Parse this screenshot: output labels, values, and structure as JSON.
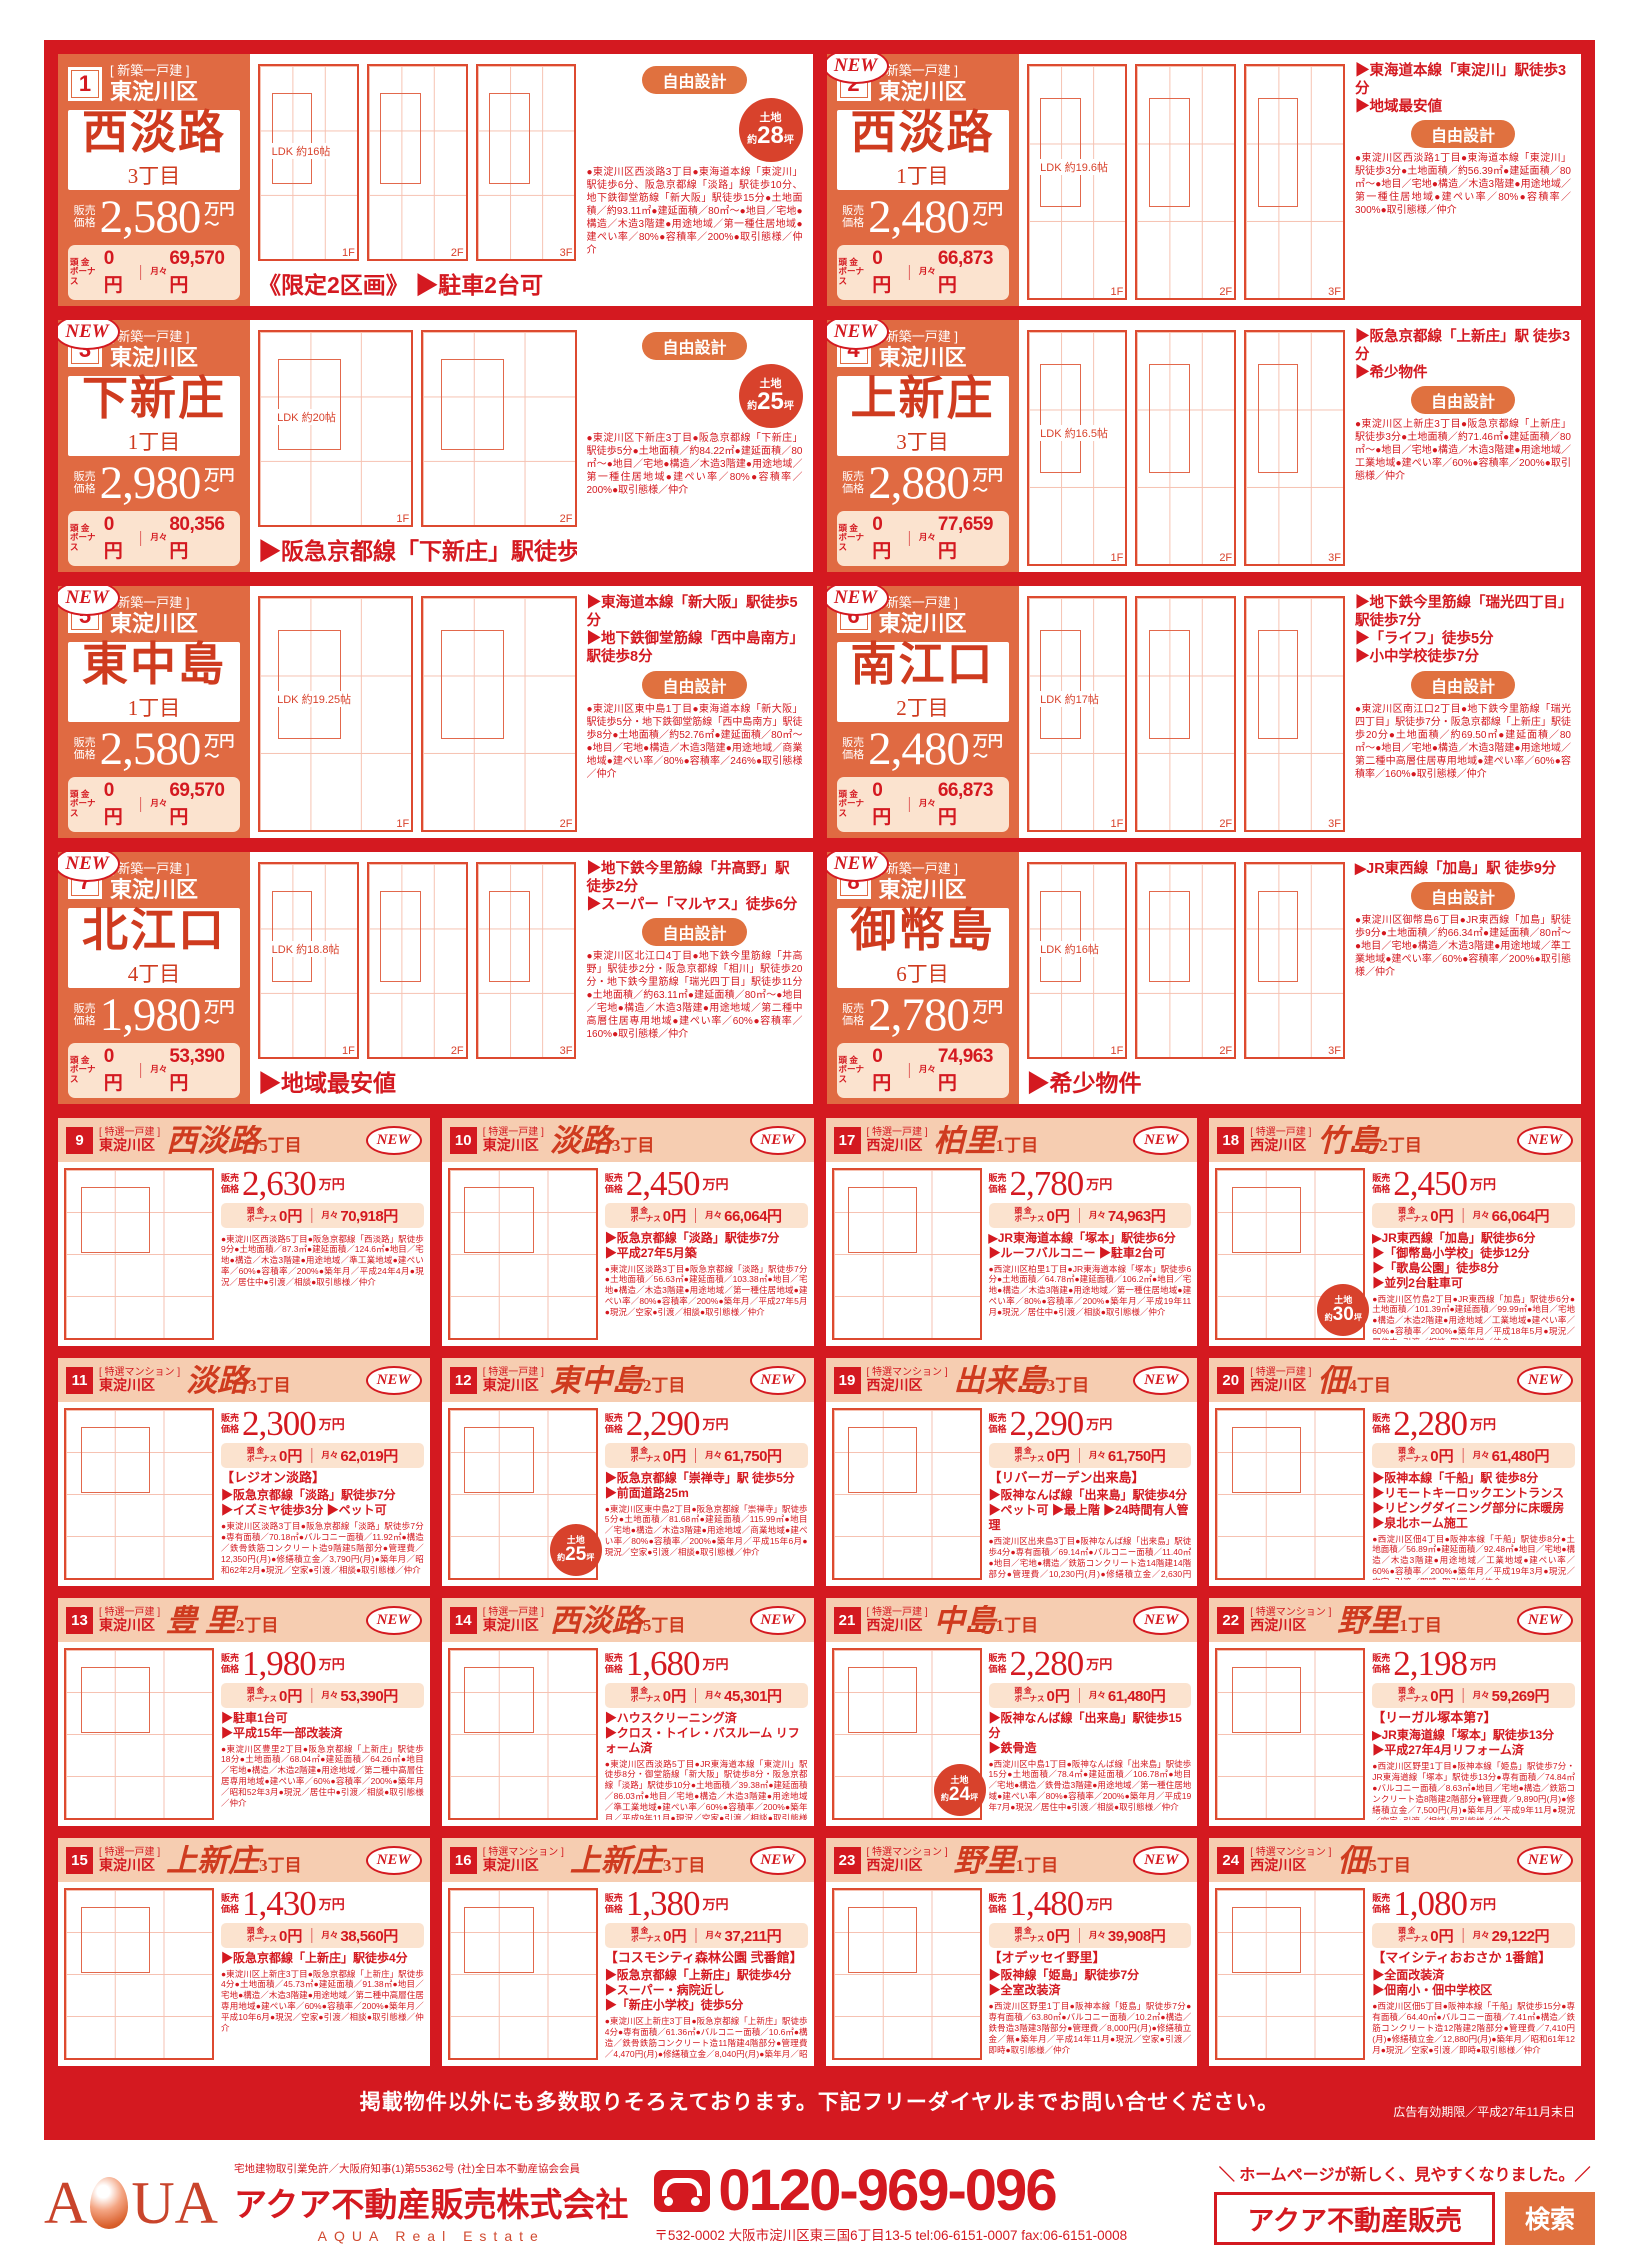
{
  "shared": {
    "new_label": "NEW",
    "price_label": [
      "販売",
      "価格"
    ],
    "unit": "万円",
    "tilde": "〜",
    "down1": "頭 金",
    "down2": "ボーナス",
    "zero": "0円",
    "sep": "｜",
    "monthly_label": "月々",
    "yen": "円",
    "land_label": "土地",
    "land_pre": "約",
    "land_suf": "坪"
  },
  "big_listings": [
    {
      "num": "1",
      "new": false,
      "type": "[ 新築一戸建 ]",
      "ward": "東淀川区",
      "name": "西淡路",
      "chome": "3丁目",
      "price": "2,580",
      "monthly": "69,570",
      "headline": "《限定2区画》 ▶駐車2台可",
      "bullets": [],
      "pill": "自由設計",
      "land": "28",
      "plan_label": "LDK 約16帖",
      "floors": [
        "1F",
        "2F",
        "3F"
      ],
      "desc": "●東淀川区西淡路3丁目●東海道本線「東淀川」駅徒歩6分、阪急京都線「淡路」駅徒歩10分、地下鉄御堂筋線「新大阪」駅徒歩15分●土地面積／約93.11㎡●建延面積／80㎡〜●地目／宅地●構造／木造3階建●用途地域／第一種住居地域●建ぺい率／80%●容積率／200%●取引態様／仲介"
    },
    {
      "num": "2",
      "new": true,
      "type": "[ 新築一戸建 ]",
      "ward": "東淀川区",
      "name": "西淡路",
      "chome": "1丁目",
      "price": "2,480",
      "monthly": "66,873",
      "headline": "",
      "bullets": [
        "▶東海道本線「東淀川」駅徒歩3分",
        "▶地域最安値"
      ],
      "pill": "自由設計",
      "land": "",
      "plan_label": "LDK 約19.6帖",
      "floors": [
        "1F",
        "2F",
        "3F"
      ],
      "desc": "●東淀川区西淡路1丁目●東海道本線「東淀川」駅徒歩3分●土地面積／約56.39㎡●建延面積／80㎡〜●地目／宅地●構造／木造3階建●用途地域／第一種住居地域●建ぺい率／80%●容積率／300%●取引態様／仲介"
    },
    {
      "num": "3",
      "new": true,
      "type": "[ 新築一戸建 ]",
      "ward": "東淀川区",
      "name": "下新庄",
      "chome": "1丁目",
      "price": "2,980",
      "monthly": "80,356",
      "headline": "▶阪急京都線「下新庄」駅徒歩5分",
      "bullets": [],
      "pill": "自由設計",
      "land": "25",
      "plan_label": "LDK 約20帖",
      "floors": [
        "1F",
        "2F"
      ],
      "desc": "●東淀川区下新庄3丁目●阪急京都線「下新庄」駅徒歩5分●土地面積／約84.22㎡●建延面積／80㎡〜●地目／宅地●構造／木造3階建●用途地域／第一種住居地域●建ぺい率／80%●容積率／200%●取引態様／仲介"
    },
    {
      "num": "4",
      "new": true,
      "type": "[ 新築一戸建 ]",
      "ward": "東淀川区",
      "name": "上新庄",
      "chome": "3丁目",
      "price": "2,880",
      "monthly": "77,659",
      "headline": "",
      "bullets": [
        "▶阪急京都線「上新庄」駅 徒歩3分",
        "▶希少物件"
      ],
      "pill": "自由設計",
      "land": "",
      "plan_label": "LDK 約16.5帖",
      "floors": [
        "1F",
        "2F",
        "3F"
      ],
      "desc": "●東淀川区上新庄3丁目●阪急京都線「上新庄」駅徒歩3分●土地面積／約71.46㎡●建延面積／80㎡〜●地目／宅地●構造／木造3階建●用途地域／工業地域●建ぺい率／60%●容積率／200%●取引態様／仲介"
    },
    {
      "num": "5",
      "new": true,
      "type": "[ 新築一戸建 ]",
      "ward": "東淀川区",
      "name": "東中島",
      "chome": "1丁目",
      "price": "2,580",
      "monthly": "69,570",
      "headline": "",
      "bullets": [
        "▶東海道本線「新大阪」駅徒歩5分",
        "▶地下鉄御堂筋線「西中島南方」駅徒歩8分"
      ],
      "pill": "自由設計",
      "land": "",
      "plan_label": "LDK 約19.25帖",
      "floors": [
        "1F",
        "2F"
      ],
      "desc": "●東淀川区東中島1丁目●東海道本線「新大阪」駅徒歩5分・地下鉄御堂筋線「西中島南方」駅徒歩8分●土地面積／約52.76㎡●建延面積／80㎡〜●地目／宅地●構造／木造3階建●用途地域／商業地域●建ぺい率／80%●容積率／246%●取引態様／仲介"
    },
    {
      "num": "6",
      "new": true,
      "type": "[ 新築一戸建 ]",
      "ward": "東淀川区",
      "name": "南江口",
      "chome": "2丁目",
      "price": "2,480",
      "monthly": "66,873",
      "headline": "",
      "bullets": [
        "▶地下鉄今里筋線「瑞光四丁目」駅徒歩7分",
        "▶「ライフ」徒歩5分",
        "▶小中学校徒歩7分"
      ],
      "pill": "自由設計",
      "land": "",
      "plan_label": "LDK 約17帖",
      "floors": [
        "1F",
        "2F",
        "3F"
      ],
      "desc": "●東淀川区南江口2丁目●地下鉄今里筋線「瑞光四丁目」駅徒歩7分・阪急京都線「上新庄」駅徒歩20分●土地面積／約69.50㎡●建延面積／80㎡〜●地目／宅地●構造／木造3階建●用途地域／第二種中高層住居専用地域●建ぺい率／60%●容積率／160%●取引態様／仲介"
    },
    {
      "num": "7",
      "new": true,
      "type": "[ 新築一戸建 ]",
      "ward": "東淀川区",
      "name": "北江口",
      "chome": "4丁目",
      "price": "1,980",
      "monthly": "53,390",
      "headline": "▶地域最安値",
      "bullets": [
        "▶地下鉄今里筋線「井高野」駅徒歩2分",
        "▶スーパー「マルヤス」徒歩6分"
      ],
      "pill": "自由設計",
      "land": "",
      "plan_label": "LDK 約18.8帖",
      "floors": [
        "1F",
        "2F",
        "3F"
      ],
      "desc": "●東淀川区北江口4丁目●地下鉄今里筋線「井高野」駅徒歩2分・阪急京都線「相川」駅徒歩20分・地下鉄今里筋線「瑞光四丁目」駅徒歩11分●土地面積／約63.11㎡●建延面積／80㎡〜●地目／宅地●構造／木造3階建●用途地域／第二種中高層住居専用地域●建ぺい率／60%●容積率／160%●取引態様／仲介"
    },
    {
      "num": "8",
      "new": true,
      "type": "[ 新築一戸建 ]",
      "ward": "東淀川区",
      "name": "御幣島",
      "chome": "6丁目",
      "price": "2,780",
      "monthly": "74,963",
      "headline": "▶希少物件",
      "bullets": [
        "▶JR東西線「加島」駅 徒歩9分"
      ],
      "pill": "自由設計",
      "land": "",
      "plan_label": "LDK 約16帖",
      "floors": [
        "1F",
        "2F",
        "3F"
      ],
      "desc": "●東淀川区御幣島6丁目●JR東西線「加島」駅徒歩9分●土地面積／約66.34㎡●建延面積／80㎡〜●地目／宅地●構造／木造3階建●用途地域／準工業地域●建ぺい率／60%●容積率／200%●取引態様／仲介"
    }
  ],
  "small_listings": [
    {
      "num": "9",
      "new": true,
      "type": "[ 特選一戸建 ]",
      "ward": "東淀川区",
      "name": "西淡路",
      "chome": "5丁目",
      "price": "2,630",
      "monthly": "70,918",
      "bldg": "",
      "bullets": [],
      "land": "",
      "desc": "●東淀川区西淡路5丁目●阪急京都線「西淡路」駅徒歩9分●土地面積／87.3㎡●建延面積／124.6㎡●地目／宅地●構造／木造3階建●用途地域／準工業地域●建ぺい率／60%●容積率／200%●築年月／平成24年4月●現況／居住中●引渡／相談●取引態様／仲介"
    },
    {
      "num": "10",
      "new": true,
      "type": "[ 特選一戸建 ]",
      "ward": "東淀川区",
      "name": "淡路",
      "chome": "3丁目",
      "price": "2,450",
      "monthly": "66,064",
      "bldg": "",
      "bullets": [
        "▶阪急京都線「淡路」駅徒歩7分",
        "▶平成27年5月築"
      ],
      "land": "",
      "desc": "●東淀川区淡路3丁目●阪急京都線「淡路」駅徒歩7分●土地面積／56.63㎡●建延面積／103.38㎡●地目／宅地●構造／木造3階建●用途地域／第一種住居地域●建ぺい率／80%●容積率／200%●築年月／平成27年5月●現況／空家●引渡／相談●取引態様／仲介"
    },
    {
      "num": "17",
      "new": true,
      "type": "[ 特選一戸建 ]",
      "ward": "西淀川区",
      "name": "柏里",
      "chome": "1丁目",
      "price": "2,780",
      "monthly": "74,963",
      "bldg": "",
      "bullets": [
        "▶JR東海道本線「塚本」駅徒歩6分",
        "▶ルーフバルコニー ▶駐車2台可"
      ],
      "land": "",
      "desc": "●西淀川区柏里1丁目●JR東海道本線「塚本」駅徒歩6分●土地面積／64.78㎡●建延面積／106.2㎡●地目／宅地●構造／木造3階建●用途地域／第一種住居地域●建ぺい率／80%●容積率／200%●築年月／平成19年11月●現況／居住中●引渡／相談●取引態様／仲介"
    },
    {
      "num": "18",
      "new": true,
      "type": "[ 特選一戸建 ]",
      "ward": "西淀川区",
      "name": "竹島",
      "chome": "2丁目",
      "price": "2,450",
      "monthly": "66,064",
      "bldg": "",
      "bullets": [
        "▶JR東西線「加島」駅徒歩6分",
        "▶「御幣島小学校」徒歩12分",
        "▶「歌島公園」徒歩8分",
        "▶並列2台駐車可"
      ],
      "land": "30",
      "desc": "●西淀川区竹島2丁目●JR東西線「加島」駅徒歩6分●土地面積／101.39㎡●建延面積／99.99㎡●地目／宅地●構造／木造2階建●用途地域／工業地域●建ぺい率／60%●容積率／200%●築年月／平成18年5月●現況／居住中●引渡／相談●取引態様／仲介"
    },
    {
      "num": "11",
      "new": true,
      "type": "[ 特選マンション ]",
      "ward": "東淀川区",
      "name": "淡路",
      "chome": "3丁目",
      "price": "2,300",
      "monthly": "62,019",
      "bldg": "【レジオン淡路】",
      "bullets": [
        "▶阪急京都線「淡路」駅徒歩7分",
        "▶イズミヤ徒歩3分 ▶ペット可"
      ],
      "land": "",
      "desc": "●東淀川区淡路3丁目●阪急京都線「淡路」駅徒歩7分●専有面積／70.18㎡●バルコニー面積／11.92㎡●構造／鉄骨鉄筋コンクリート造9階建5階部分●管理費／12,350円(月)●修繕積立金／3,790円(月)●築年月／昭和62年2月●現況／空家●引渡／相談●取引態様／仲介"
    },
    {
      "num": "12",
      "new": true,
      "type": "[ 特選一戸建 ]",
      "ward": "東淀川区",
      "name": "東中島",
      "chome": "2丁目",
      "price": "2,290",
      "monthly": "61,750",
      "bldg": "",
      "bullets": [
        "▶阪急京都線「崇禅寺」駅 徒歩5分",
        "▶前面道路25m"
      ],
      "land": "25",
      "desc": "●東淀川区東中島2丁目●阪急京都線「崇禅寺」駅徒歩5分●土地面積／81.68㎡●建延面積／115.99㎡●地目／宅地●構造／木造3階建●用途地域／商業地域●建ぺい率／80%●容積率／200%●築年月／平成15年6月●現況／空家●引渡／相談●取引態様／仲介"
    },
    {
      "num": "19",
      "new": true,
      "type": "[ 特選マンション ]",
      "ward": "西淀川区",
      "name": "出来島",
      "chome": "3丁目",
      "price": "2,290",
      "monthly": "61,750",
      "bldg": "【リバーガーデン出来島】",
      "bullets": [
        "▶阪神なんば線「出来島」駅徒歩4分",
        "▶ペット可 ▶最上階 ▶24時間有人管理"
      ],
      "land": "",
      "desc": "●西淀川区出来島3丁目●阪神なんば線「出来島」駅徒歩4分●専有面積／69.14㎡●バルコニー面積／11.40㎡●地目／宅地●構造／鉄筋コンクリート造14階建14階部分●管理費／10,230円(月)●修繕積立金／2,630円(月)●築年月／平成18年7月●現況／空家●引渡／即時●取引態様／仲介"
    },
    {
      "num": "20",
      "new": true,
      "type": "[ 特選一戸建 ]",
      "ward": "西淀川区",
      "name": "佃",
      "chome": "4丁目",
      "price": "2,280",
      "monthly": "61,480",
      "bldg": "",
      "bullets": [
        "▶阪神本線「千船」駅 徒歩8分",
        "▶リモートキーロックエントランス",
        "▶リビングダイニング部分に床暖房",
        "▶泉北ホーム施工"
      ],
      "land": "",
      "desc": "●西淀川区佃4丁目●阪神本線「千船」駅徒歩8分●土地面積／56.89㎡●建延面積／92.48㎡●地目／宅地●構造／木造3階建●用途地域／工業地域●建ぺい率／60%●容積率／200%●築年月／平成19年3月●現況／空家●引渡／即時●取引態様／仲介"
    },
    {
      "num": "13",
      "new": true,
      "type": "[ 特選一戸建 ]",
      "ward": "東淀川区",
      "name": "豊 里",
      "chome": "2丁目",
      "price": "1,980",
      "monthly": "53,390",
      "bldg": "",
      "bullets": [
        "▶駐車1台可",
        "▶平成15年一部改装済"
      ],
      "land": "",
      "desc": "●東淀川区豊里2丁目●阪急京都線「上新庄」駅徒歩18分●土地面積／68.04㎡●建延面積／64.26㎡●地目／宅地●構造／木造2階建●用途地域／第二種中高層住居専用地域●建ぺい率／60%●容積率／200%●築年月／昭和52年3月●現況／居住中●引渡／相談●取引態様／仲介"
    },
    {
      "num": "14",
      "new": true,
      "type": "[ 特選一戸建 ]",
      "ward": "東淀川区",
      "name": "西淡路",
      "chome": "5丁目",
      "price": "1,680",
      "monthly": "45,301",
      "bldg": "",
      "bullets": [
        "▶ハウスクリーニング済",
        "▶クロス・トイレ・バスルーム リフォーム済"
      ],
      "land": "",
      "desc": "●東淀川区西淡路5丁目●JR東海道本線「東淀川」駅徒歩8分・御堂筋線「新大阪」駅徒歩8分・阪急京都線「淡路」駅徒歩10分●土地面積／39.38㎡●建延面積／86.03㎡●地目／宅地●構造／木造3階建●用途地域／準工業地域●建ぺい率／60%●容積率／200%●築年月／平成9年11月●現況／空家●引渡／相談●取引態様／仲介"
    },
    {
      "num": "21",
      "new": true,
      "type": "[ 特選一戸建 ]",
      "ward": "西淀川区",
      "name": "中島",
      "chome": "1丁目",
      "price": "2,280",
      "monthly": "61,480",
      "bldg": "",
      "bullets": [
        "▶阪神なんば線「出来島」駅徒歩15分",
        "▶鉄骨造"
      ],
      "land": "24",
      "desc": "●西淀川区中島1丁目●阪神なんば線「出来島」駅徒歩15分●土地面積／78.4㎡●建延面積／106.78㎡●地目／宅地●構造／鉄骨造3階建●用途地域／第一種住居地域●建ぺい率／80%●容積率／200%●築年月／平成19年7月●現況／居住中●引渡／相談●取引態様／仲介"
    },
    {
      "num": "22",
      "new": true,
      "type": "[ 特選マンション ]",
      "ward": "西淀川区",
      "name": "野里",
      "chome": "1丁目",
      "price": "2,198",
      "monthly": "59,269",
      "bldg": "【リーガル塚本第7】",
      "bullets": [
        "▶JR東海道線「塚本」駅徒歩13分",
        "▶平成27年4月リフォーム済"
      ],
      "land": "",
      "desc": "●西淀川区野里1丁目●阪神本線「姫島」駅徒歩7分・JR東海道線「塚本」駅徒歩13分●専有面積／74.84㎡●バルコニー面積／8.63㎡●地目／宅地●構造／鉄筋コンクリート造8階建2階部分●管理費／9,890円(月)●修繕積立金／7,500円(月)●築年月／平成9年11月●現況／空家●引渡／相談●取引態様／仲介"
    },
    {
      "num": "15",
      "new": true,
      "type": "[ 特選一戸建 ]",
      "ward": "東淀川区",
      "name": "上新庄",
      "chome": "3丁目",
      "price": "1,430",
      "monthly": "38,560",
      "bldg": "",
      "bullets": [
        "▶阪急京都線「上新庄」駅徒歩4分"
      ],
      "land": "",
      "desc": "●東淀川区上新庄3丁目●阪急京都線「上新庄」駅徒歩4分●土地面積／45.73㎡●建延面積／91.38㎡●地目／宅地●構造／木造3階建●用途地域／第二種中高層住居専用地域●建ぺい率／60%●容積率／200%●築年月／平成10年6月●現況／空家●引渡／相談●取引態様／仲介"
    },
    {
      "num": "16",
      "new": true,
      "type": "[ 特選マンション ]",
      "ward": "東淀川区",
      "name": "上新庄",
      "chome": "3丁目",
      "price": "1,380",
      "monthly": "37,211",
      "bldg": "【コスモシティ森林公園 弐番館】",
      "bullets": [
        "▶阪急京都線「上新庄」駅徒歩4分",
        "▶スーパー・病院近し",
        "▶「新庄小学校」徒歩5分"
      ],
      "land": "",
      "desc": "●東淀川区上新庄3丁目●阪急京都線「上新庄」駅徒歩4分●専有面積／61.36㎡●バルコニー面積／10.6㎡●構造／鉄骨鉄筋コンクリート造11階建4階部分●管理費／4,470円(月)●修繕積立金／8,040円(月)●築年月／昭和63年3月●現況／空家●引渡／相談●取引態様／仲介"
    },
    {
      "num": "23",
      "new": true,
      "type": "[ 特選マンション ]",
      "ward": "西淀川区",
      "name": "野里",
      "chome": "1丁目",
      "price": "1,480",
      "monthly": "39,908",
      "bldg": "【オデッセイ野里】",
      "bullets": [
        "▶阪神線「姫島」駅徒歩7分",
        "▶全室改装済"
      ],
      "land": "",
      "desc": "●西淀川区野里1丁目●阪神本線「姫島」駅徒歩7分●専有面積／63.80㎡●バルコニー面積／10.2㎡●構造／鉄骨造3階建3階部分●管理費／8,000円(月)●修繕積立金／無●築年月／平成14年11月●現況／空家●引渡／即時●取引態様／仲介"
    },
    {
      "num": "24",
      "new": true,
      "type": "[ 特選マンション ]",
      "ward": "西淀川区",
      "name": "佃",
      "chome": "5丁目",
      "price": "1,080",
      "monthly": "29,122",
      "bldg": "【マイシティおおさか 1番館】",
      "bullets": [
        "▶全面改装済",
        "▶佃南小・佃中学校区"
      ],
      "land": "",
      "desc": "●西淀川区佃5丁目●阪神本線「千船」駅徒歩15分●専有面積／64.40㎡●バルコニー面積／7.41㎡●構造／鉄筋コンクリート造12階建2階部分●管理費／7,410円(月)●修繕積立金／12,880円(月)●築年月／昭和61年12月●現況／空家●引渡／即時●取引態様／仲介"
    }
  ],
  "notice": {
    "text": "掲載物件以外にも多数取りそろえております。下記フリーダイヤルまでお問い合せください。",
    "expiry": "広告有効期限／平成27年11月末日"
  },
  "footer": {
    "license": "宅地建物取引業免許／大阪府知事(1)第55362号 (社)全日本不動産協会会員",
    "company": "アクア不動産販売株式会社",
    "company_en": "AQUA Real Estate",
    "logo_a": "A",
    "logo_ua": "UA",
    "phone": "0120-969-096",
    "address": "〒532-0002 大阪市淀川区東三国6丁目13-5 tel:06-6151-0007 fax:06-6151-0008",
    "homepage_note": "＼ ホームページが新しく、見やすくなりました。／",
    "search_text": "アクア不動産販売",
    "search_button": "検索"
  }
}
